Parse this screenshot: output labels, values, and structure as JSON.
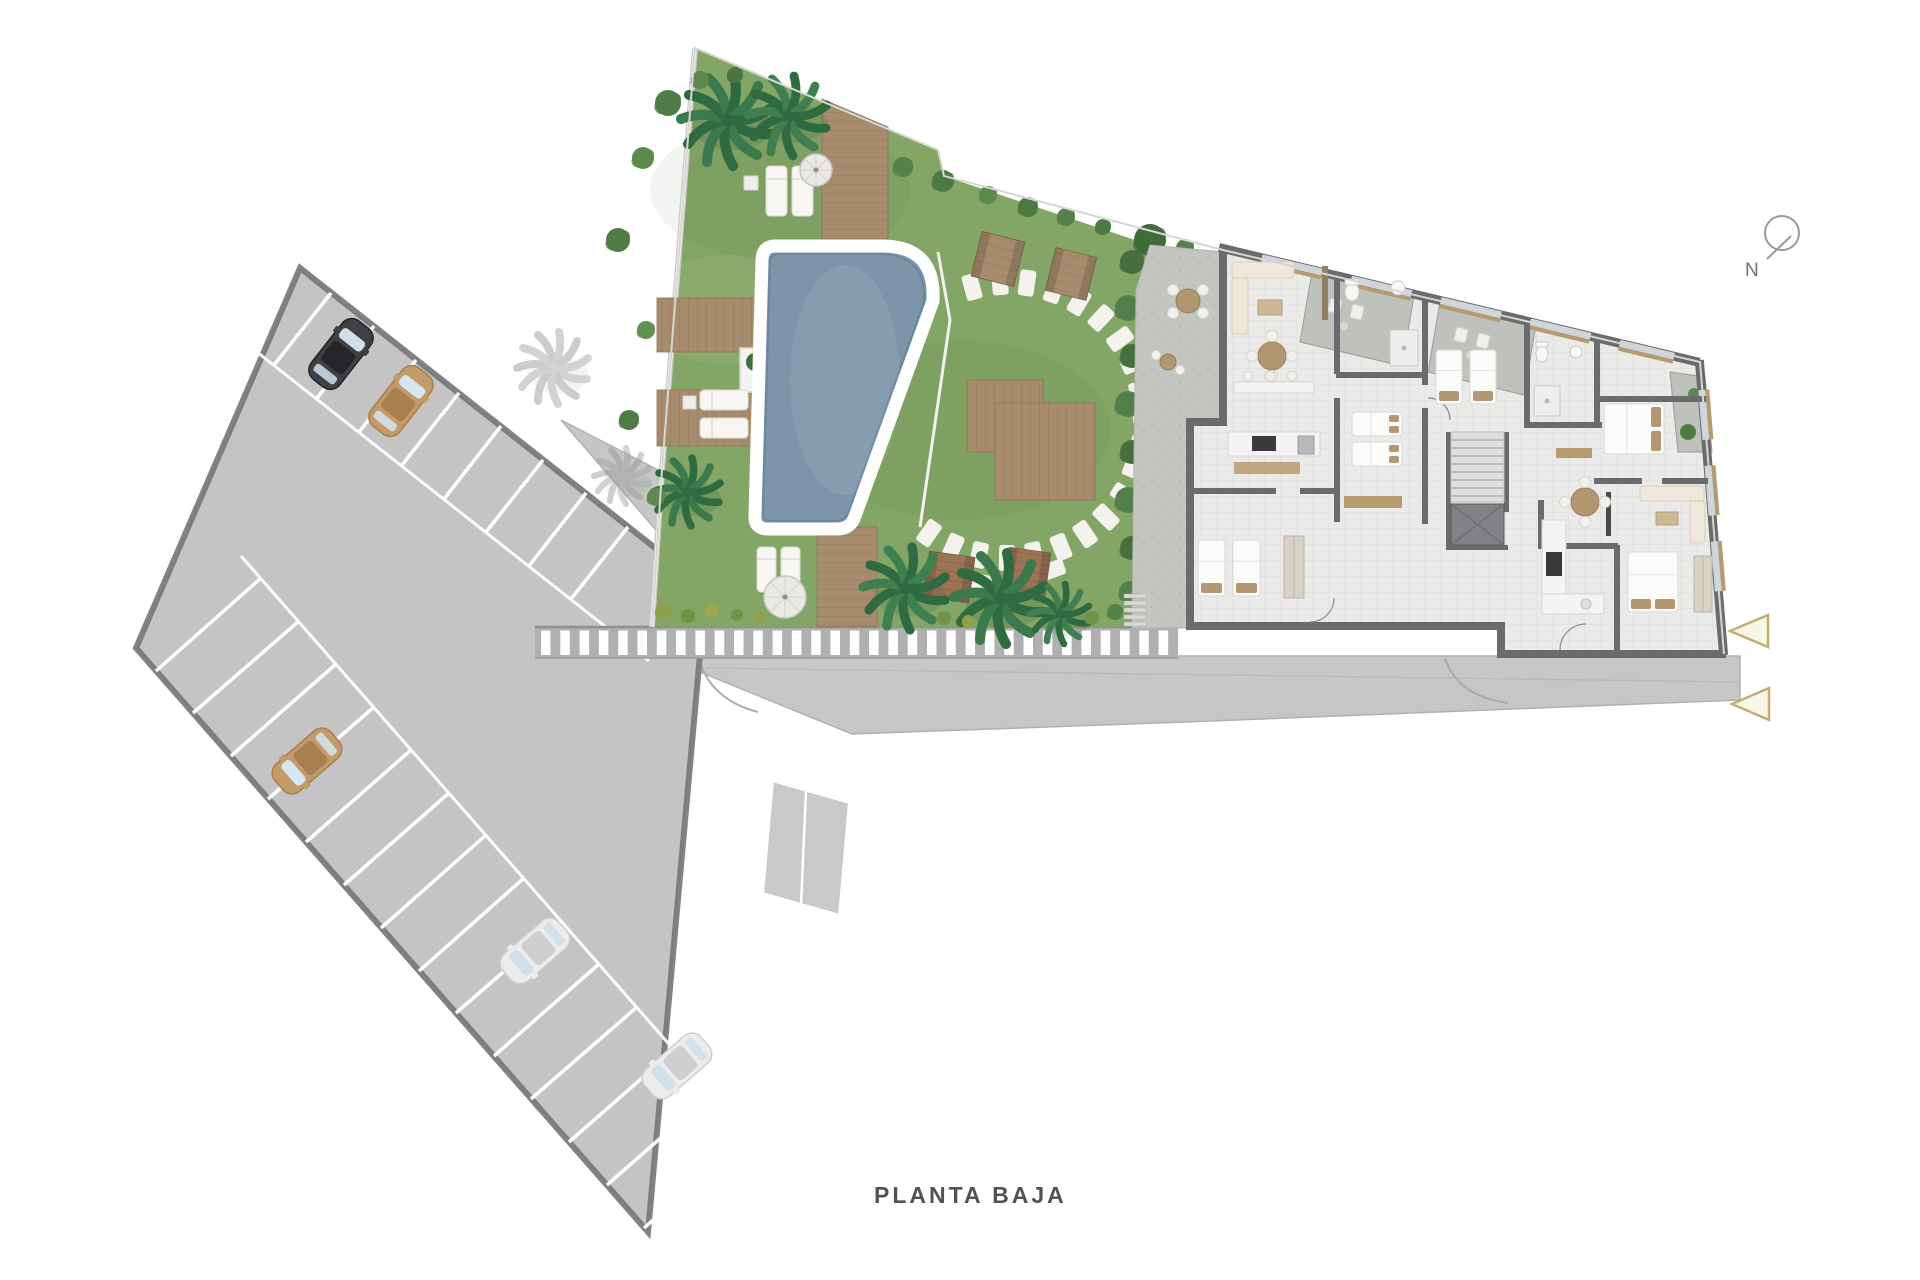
{
  "page": {
    "floor_label": "PLANTA BAJA"
  },
  "compass": {
    "label": "N"
  },
  "palette": {
    "background": "#ffffff",
    "grass": "#83a565",
    "pool_water": "#7d95aa",
    "deck_wood": "#a78b6d",
    "parking_asphalt": "#cbcbcb",
    "road_asphalt": "#c6c6c6",
    "building_wall": "#696b6e",
    "building_floor": "#eaeae8",
    "terrace_gray": "#bfc1bd",
    "entrance_marker": "#c3ad72",
    "label_text": "#515254"
  }
}
